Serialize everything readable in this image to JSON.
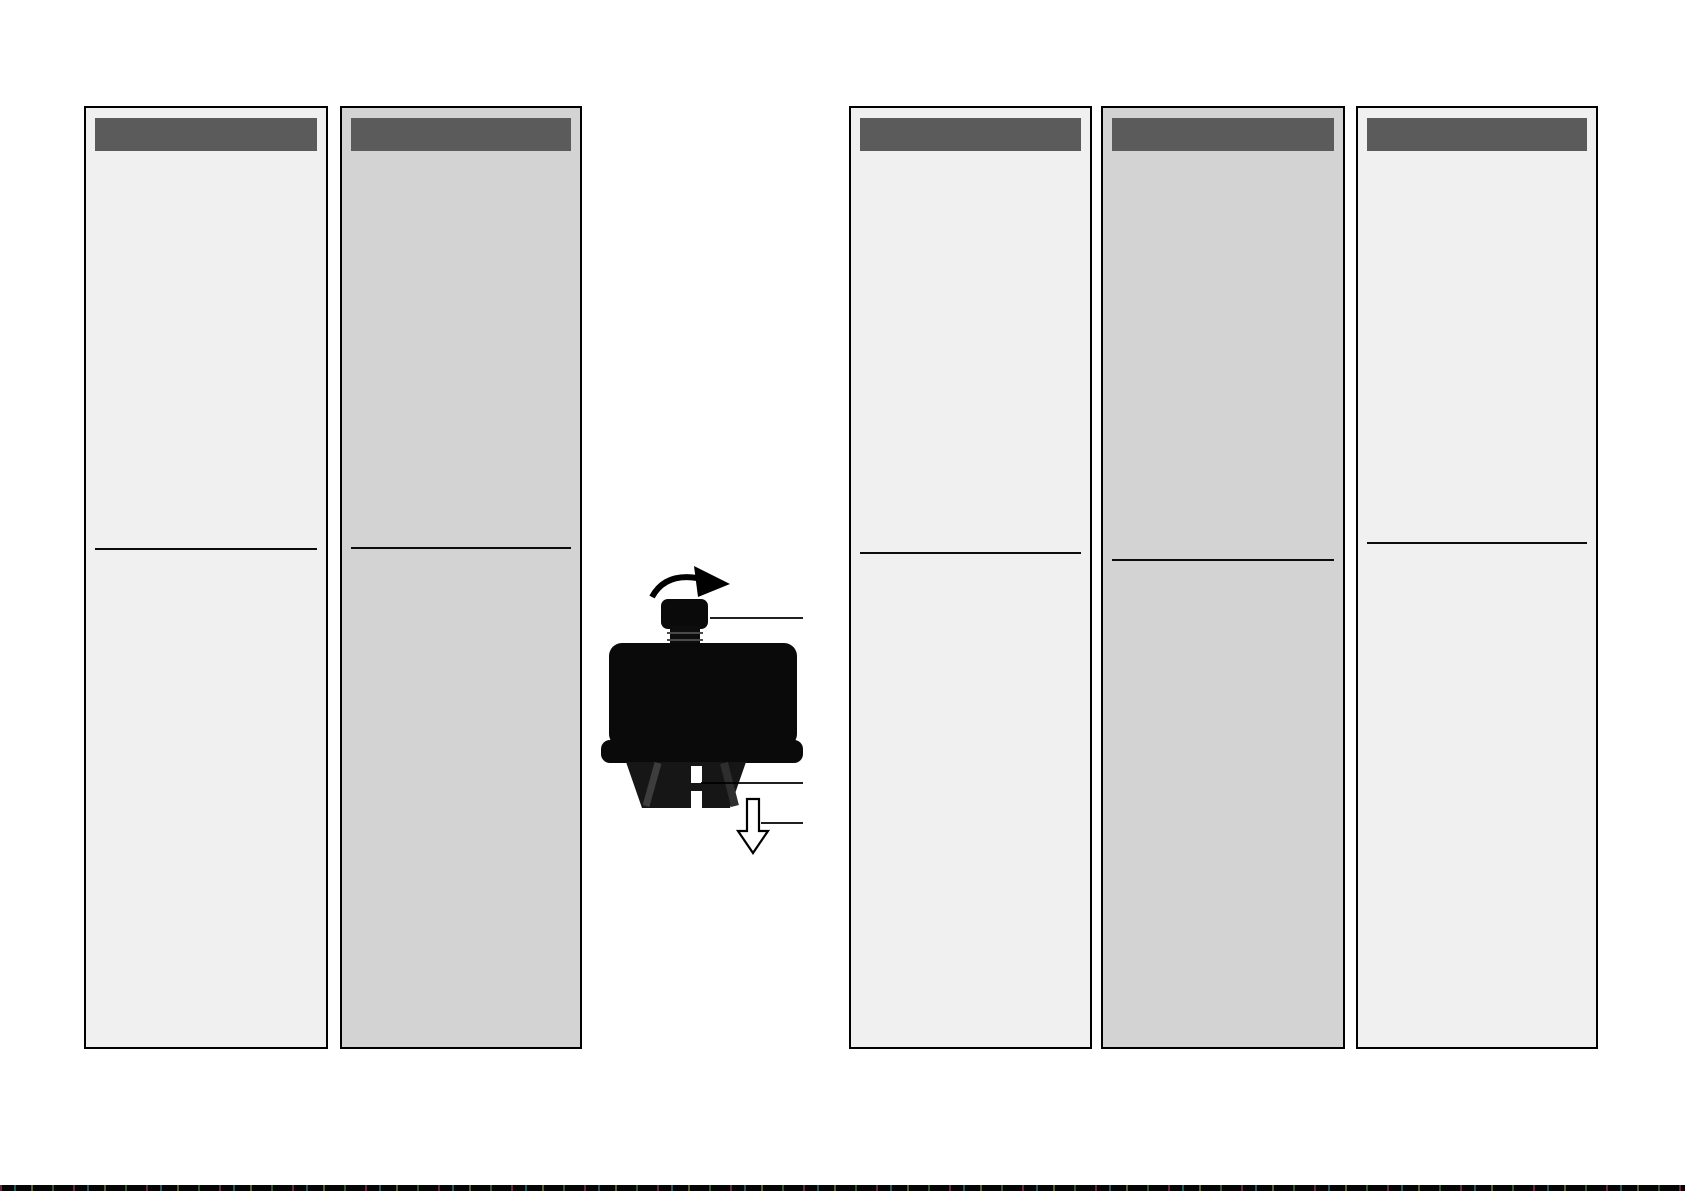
{
  "document": {
    "kind": "printed-instruction-leaflet-page",
    "background": "#ffffff",
    "visible_text": ""
  },
  "palette": {
    "column_light_bg": "#f0f0f0",
    "column_dark_bg": "#d3d3d3",
    "header_bar": "#5b5b5b",
    "border": "#000000",
    "rule": "#0c0c0c",
    "illustration_ink": "#000000",
    "bottom_strip": "#050505"
  },
  "columns": [
    {
      "name": "column-1",
      "tone": "light",
      "header_label": "",
      "body_label": ""
    },
    {
      "name": "column-2",
      "tone": "dark",
      "header_label": "",
      "body_label": ""
    },
    {
      "name": "column-3",
      "tone": "light",
      "header_label": "",
      "body_label": ""
    },
    {
      "name": "column-4",
      "tone": "dark",
      "header_label": "",
      "body_label": ""
    },
    {
      "name": "column-5",
      "tone": "light",
      "header_label": "",
      "body_label": ""
    }
  ],
  "illustration": {
    "subject": "push-in fastener with turn knob",
    "rotation_arrow_direction": "clockwise",
    "insertion_arrow_direction": "down",
    "leader_line_count": 3,
    "caption": ""
  },
  "footer": {
    "has_edge_strip": true
  }
}
